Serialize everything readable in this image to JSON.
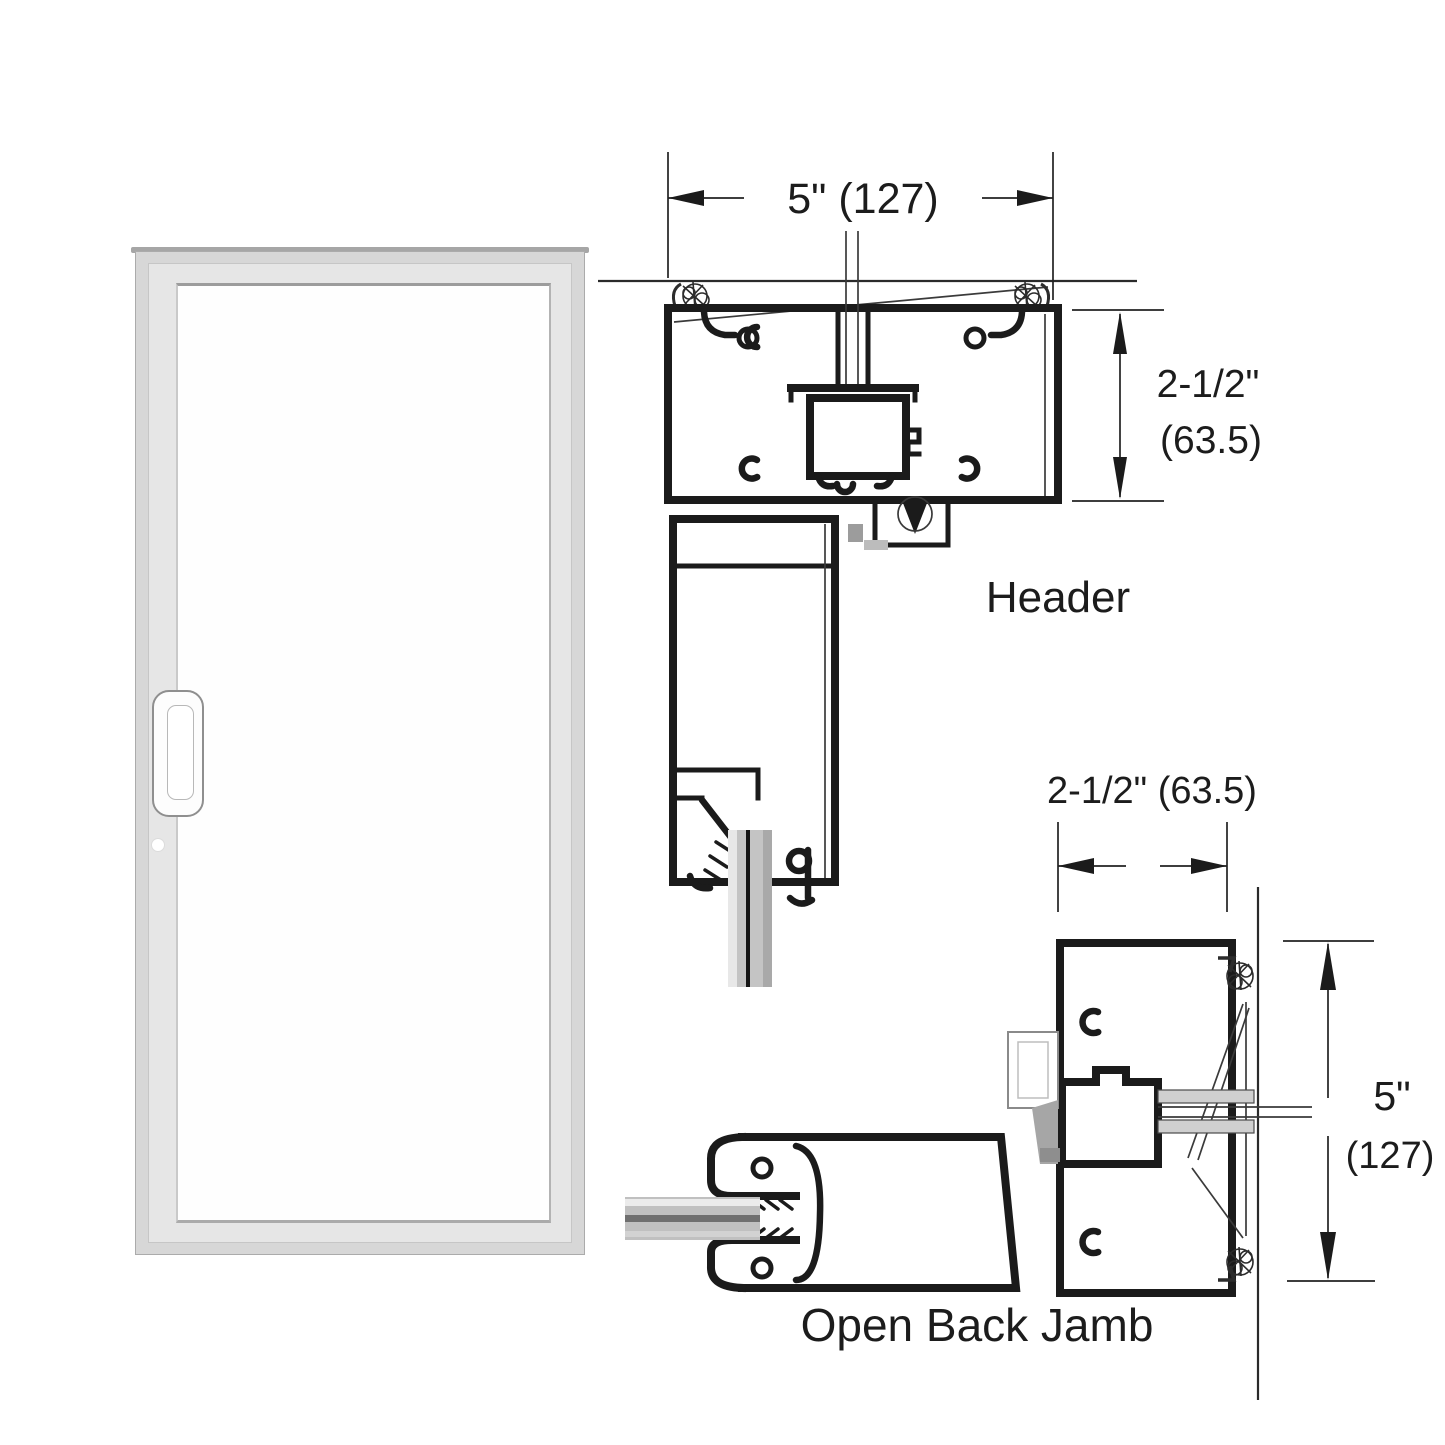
{
  "page": {
    "background": "#ffffff"
  },
  "door_elevation": {
    "frame_color": "#d7d7d7",
    "leaf_color": "#e6e6e6",
    "glass_color": "#fefefe",
    "cap_color": "#a6a6a6"
  },
  "header_detail": {
    "label": "Header",
    "width_dim": "5\" (127)",
    "depth_dim_line1": "2-1/2\"",
    "depth_dim_line2": "(63.5)"
  },
  "jamb_detail": {
    "label": "Open Back Jamb",
    "width_dim": "2-1/2\" (63.5)",
    "depth_dim_line1": "5\"",
    "depth_dim_line2": "(127)"
  },
  "colors": {
    "line": "#1b1b1b",
    "section_glass_fill": "#c4c4c4",
    "glass_core_line": "#141414"
  }
}
